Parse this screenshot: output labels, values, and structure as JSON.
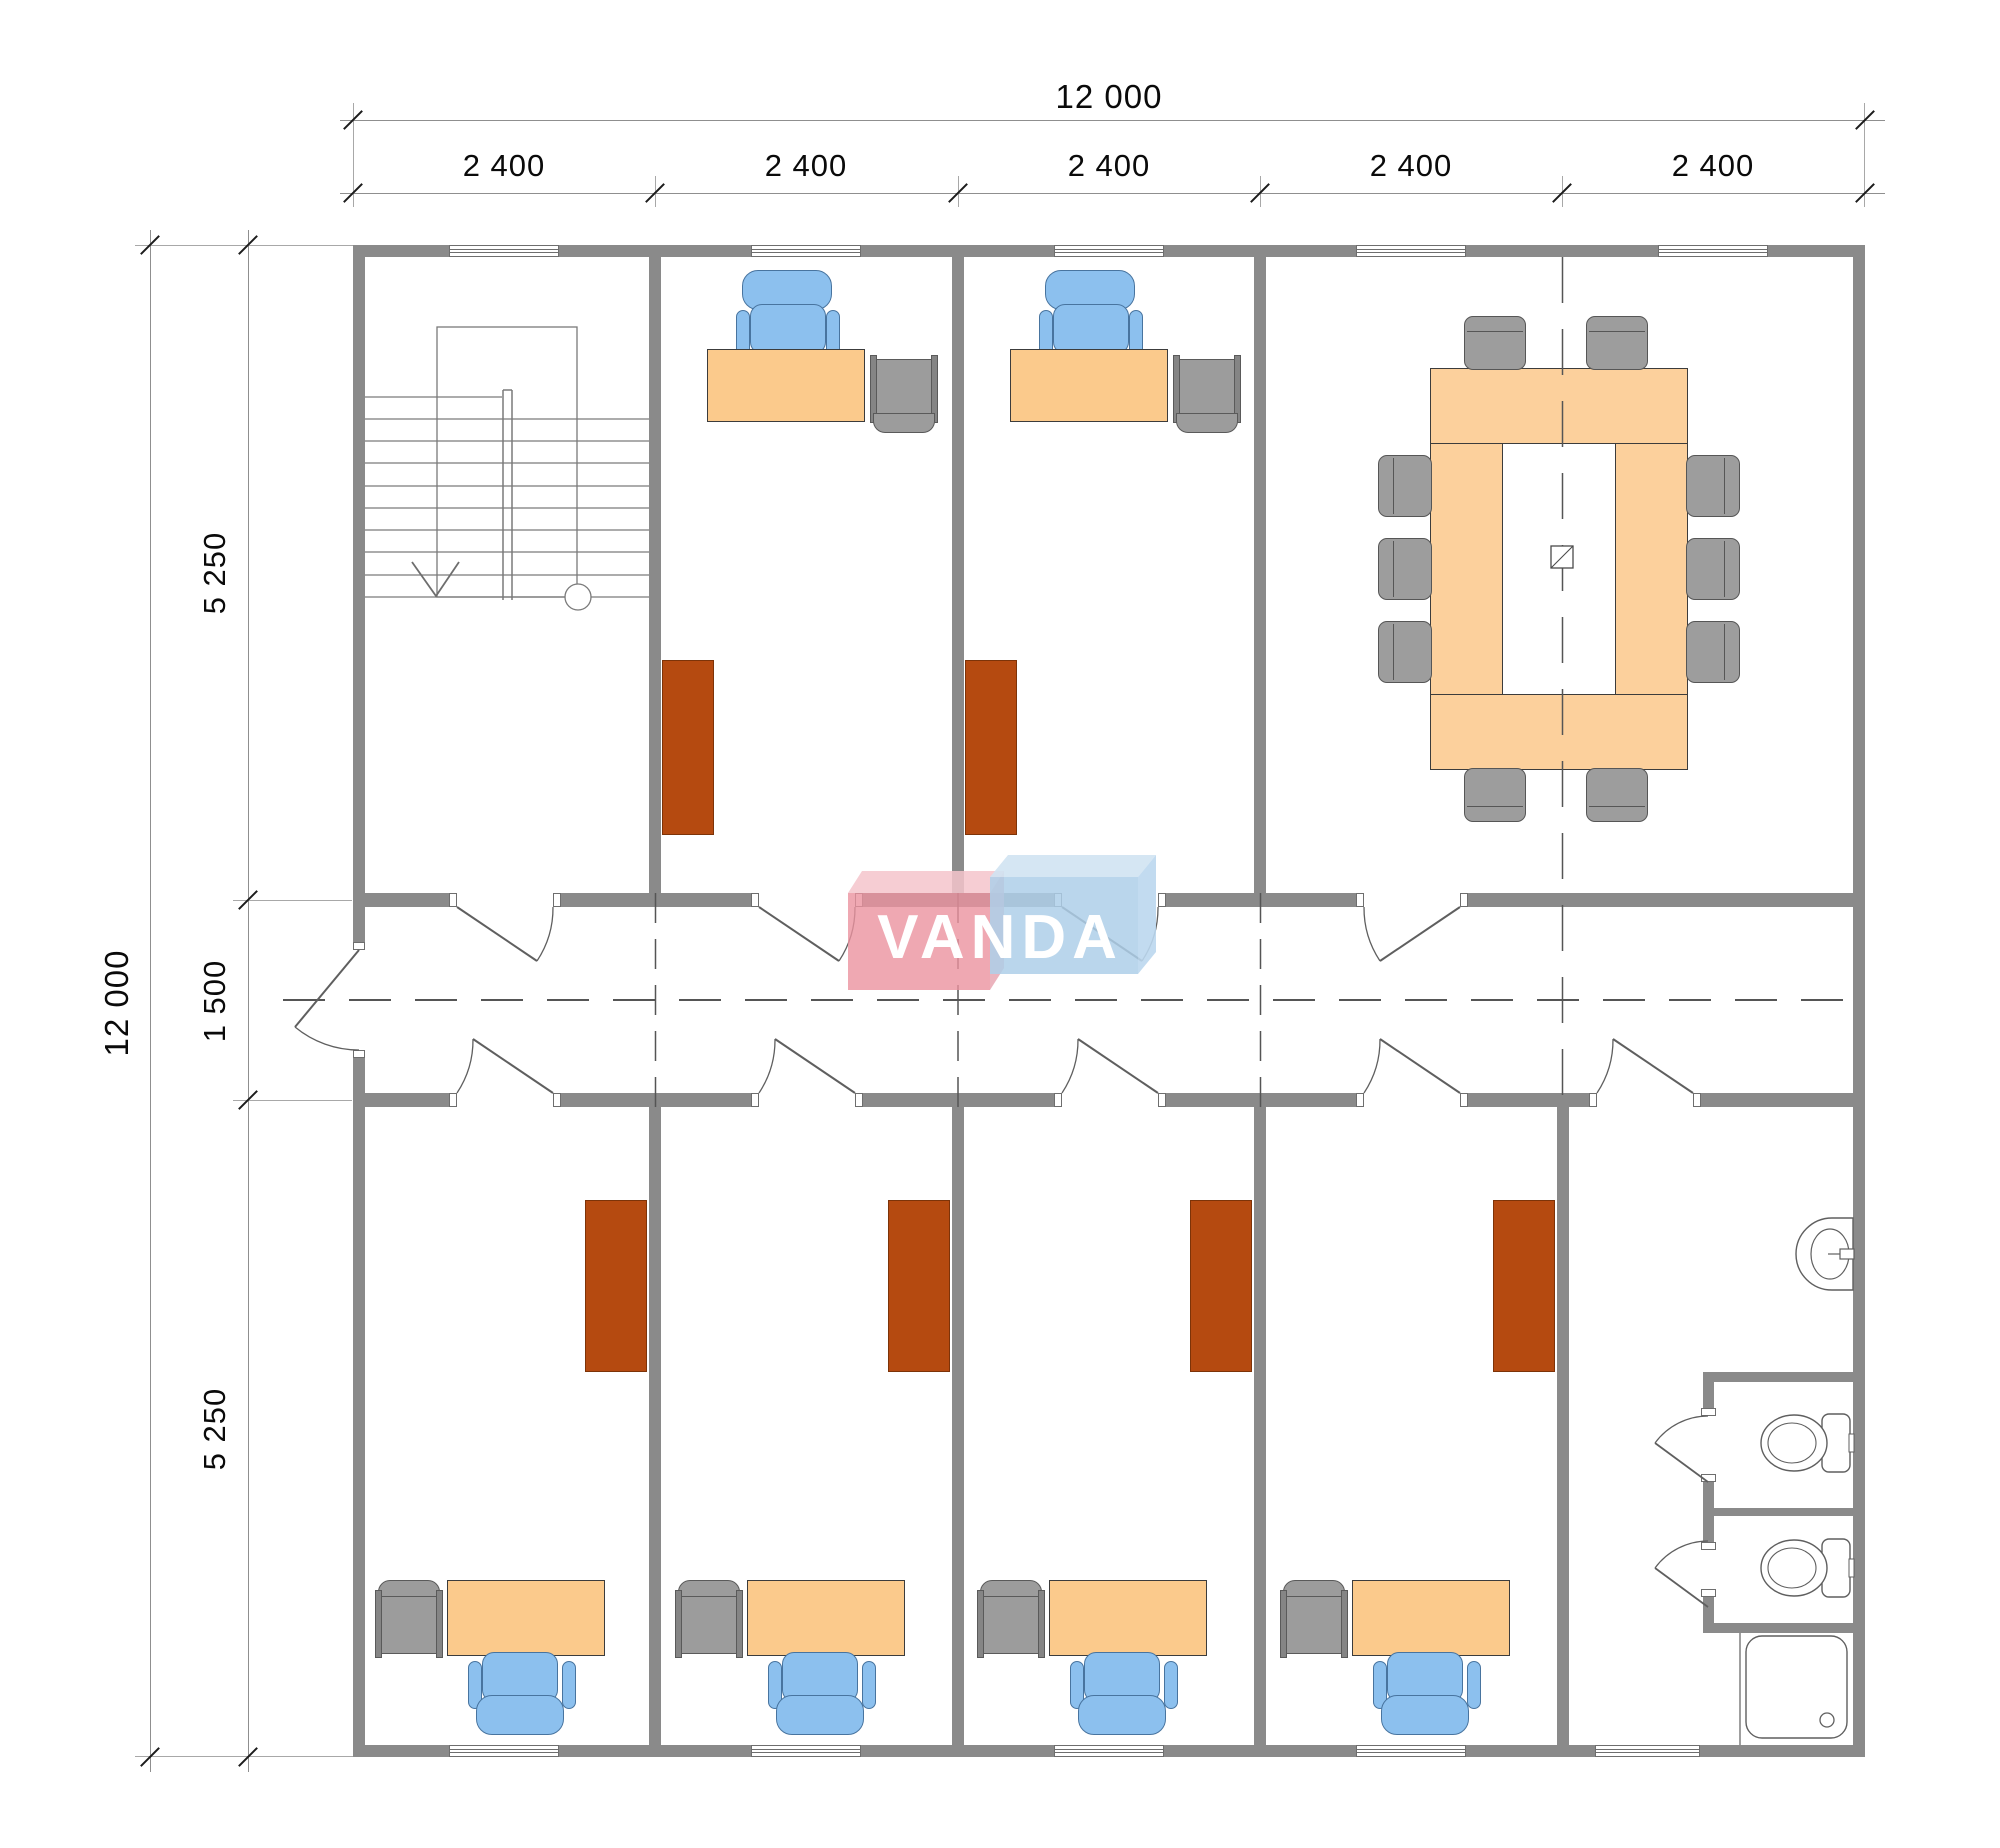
{
  "dimensions": {
    "top": {
      "overall": "12 000",
      "segments": [
        "2 400",
        "2 400",
        "2 400",
        "2 400",
        "2 400"
      ]
    },
    "left": {
      "overall": "12 000",
      "segments": [
        "5 250",
        "1 500",
        "5 250"
      ]
    }
  },
  "logo": {
    "text": "VANDA",
    "pink_front": "rgba(235,146,159,0.80)",
    "pink_top": "rgba(244,196,203,0.85)",
    "blue_front": "rgba(174,207,233,0.85)",
    "blue_top": "rgba(208,227,242,0.9)"
  },
  "colors": {
    "wall": "#8a8a8a",
    "desk": "#fbca8c",
    "meeting_table": "#fcd09c",
    "chair_blue": "#8cc0ee",
    "device_gray": "#9c9c9c",
    "cabinet": "#b54a10",
    "meeting_chair": "#9d9d9d"
  },
  "inventory": {
    "top_offices": 2,
    "bottom_offices": 4,
    "meeting_chairs": 10,
    "toilet_stalls": 2,
    "showers": 1,
    "basins": 1
  }
}
